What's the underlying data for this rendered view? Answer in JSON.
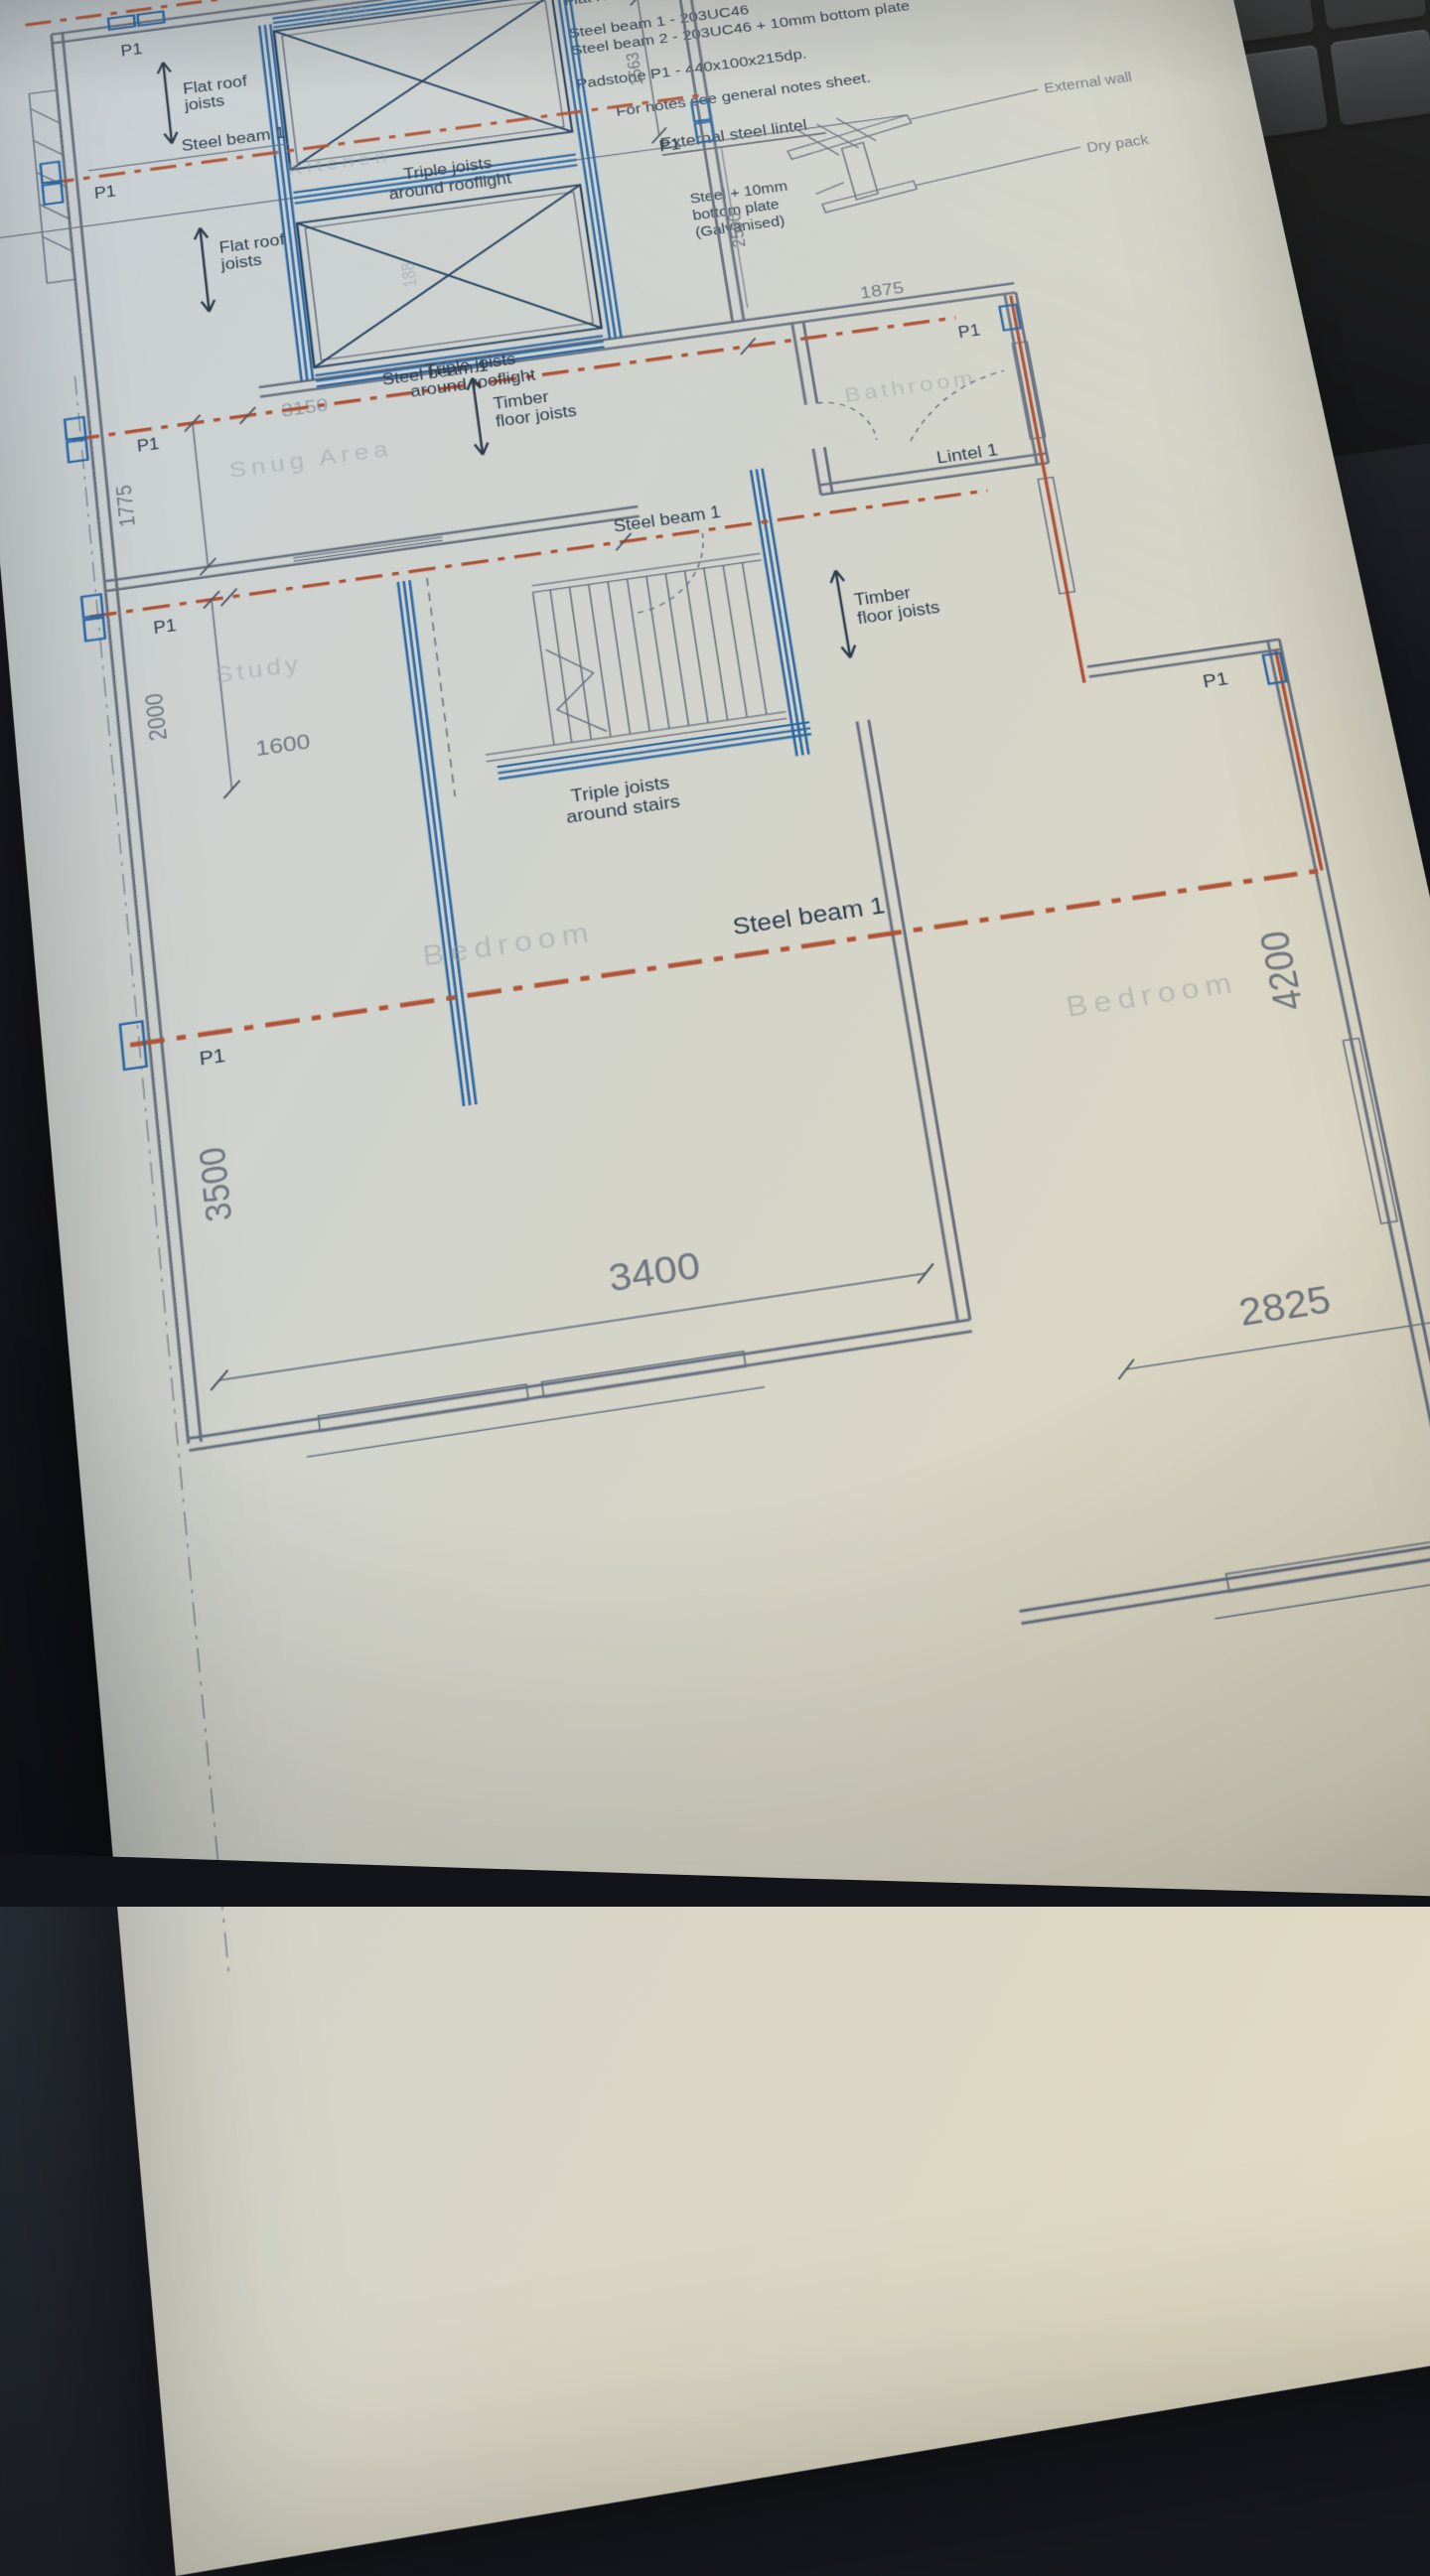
{
  "top_note": "PRIOR TO",
  "schedule": {
    "title": "Structure schedule",
    "items": [
      "Timber floor joists - 50x200dp C24 Timber members at 400ctrs",
      "Flat roof joists - 50x200dp C24 Timber members at 400ctrs",
      "Steel beam 1 - 203UC46",
      "Steel beam 2 - 203UC46 + 10mm bottom plate",
      "Padstone P1 - 440x100x215dp."
    ],
    "note": "For notes see general notes sheet."
  },
  "lintel_detail": {
    "title": "External steel lintel",
    "callout_l1": "Steel + 10mm",
    "callout_l2": "bottom plate",
    "callout_l3": "(Galvanised)",
    "external_wall": "External wall",
    "dry_pack": "Dry pack"
  },
  "labels": {
    "steel_beam_1": "Steel beam 1",
    "steel_beam_2": "Steel beam 2",
    "p1": "P1",
    "lintel_1": "Lintel 1",
    "flat_roof_l1": "Flat roof",
    "flat_roof_l2": "joists",
    "timber_l1": "Timber",
    "timber_l2": "floor joists",
    "triple_roof_l1": "Triple joists",
    "triple_roof_l2": "around rooflight",
    "triple_stairs_l1": "Triple joists",
    "triple_stairs_l2": "around stairs"
  },
  "rooms": {
    "kitchen": "Kitchen",
    "snug": "Snug Area",
    "bathroom": "Bathroom",
    "study": "Study",
    "bedroom_left": "Bedroom",
    "bedroom_right": "Bedroom"
  },
  "dims": {
    "d6000": "6000",
    "d188": "188",
    "d1563": "1563",
    "d2500": "2500",
    "d1875": "1875",
    "d3150": "3150",
    "d1775": "1775",
    "d2000": "2000",
    "d1600": "1600",
    "d3500": "3500",
    "d3400": "3400",
    "d4200": "4200",
    "d2825": "2825"
  },
  "colors": {
    "beam_red": "#b05236",
    "joist_blue": "#2866a3",
    "wall_gray": "#687080",
    "ink": "#2e3c4d",
    "paper_warm": "#e6dec4",
    "paper_cool": "#c7d0d7"
  }
}
